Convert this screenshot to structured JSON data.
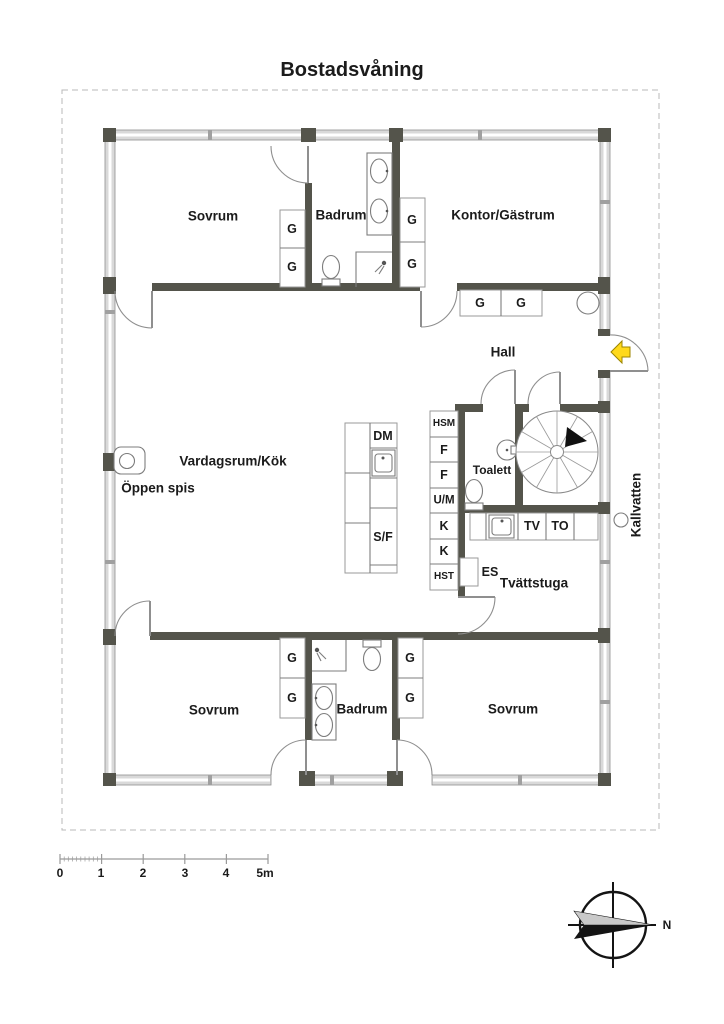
{
  "title": "Bostadsvåning",
  "rooms": {
    "bedroom_top": "Sovrum",
    "bathroom_top": "Badrum",
    "office_guestroom": "Kontor/Gästrum",
    "hall": "Hall",
    "living_kitchen": "Vardagsrum/Kök",
    "open_fireplace": "Öppen spis",
    "toilet": "Toalett",
    "laundry": "Tvättstuga",
    "bedroom_bottom_left": "Sovrum",
    "bathroom_bottom": "Badrum",
    "bedroom_bottom_right": "Sovrum"
  },
  "fixture_labels": {
    "wardrobe": "G",
    "dishwasher": "DM",
    "fridge_freezer": "S/F",
    "hsm": "HSM",
    "f": "F",
    "um": "U/M",
    "k": "K",
    "hst": "HST",
    "es": "ES",
    "washer": "TV",
    "dryer": "TO"
  },
  "annotations": {
    "cold_water": "Kallvatten",
    "north": "N"
  },
  "scale_bar": {
    "labels": [
      "0",
      "1",
      "2",
      "3",
      "4",
      "5m"
    ]
  },
  "colors": {
    "wall": "#54544b",
    "glazing": "#d9d9d9",
    "line": "#8f8f8f",
    "entrance_arrow": "#ffd91c",
    "text": "#1b1b1b"
  }
}
